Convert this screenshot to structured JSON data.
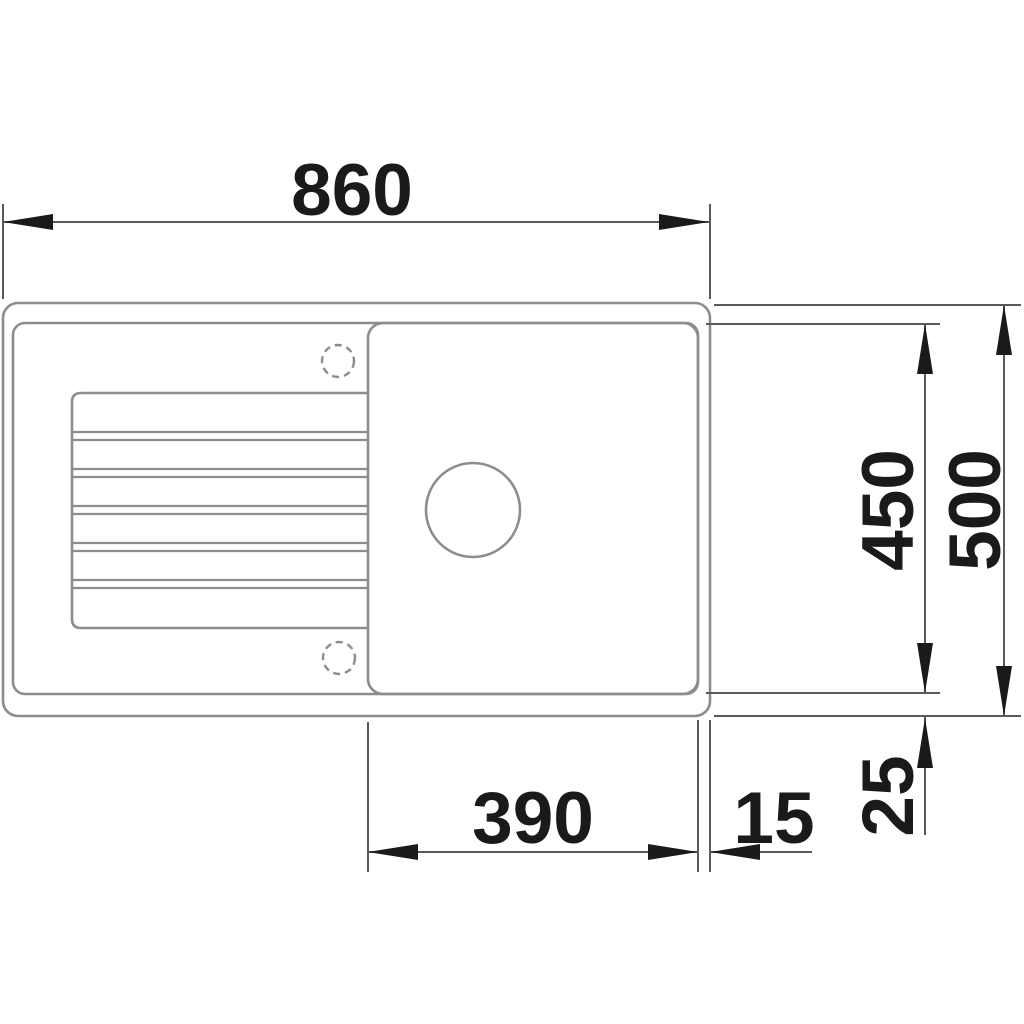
{
  "drawing": {
    "kind": "technical-dimension-drawing",
    "subject": "kitchen sink with drainboard and single bowl, top view",
    "units": "mm"
  },
  "dimensions": {
    "overall_width": "860",
    "inner_depth": "450",
    "overall_depth": "500",
    "bowl_width": "390",
    "right_rim_offset": "15",
    "bottom_rim_offset": "25"
  },
  "parts": {
    "outer_edge": "sink-outer-edge",
    "inner_rim": "sink-inner-rim",
    "bowl": "sink-bowl",
    "drainboard": "drainboard-ribs",
    "drain": "drain-hole",
    "tap_holes": "tap-hole-markers"
  },
  "colors": {
    "background": "#ffffff",
    "outline_gray": "#8d8d8d",
    "dimension_gray": "#5a5a5a",
    "arrow_text_black": "#1a1a1a"
  }
}
